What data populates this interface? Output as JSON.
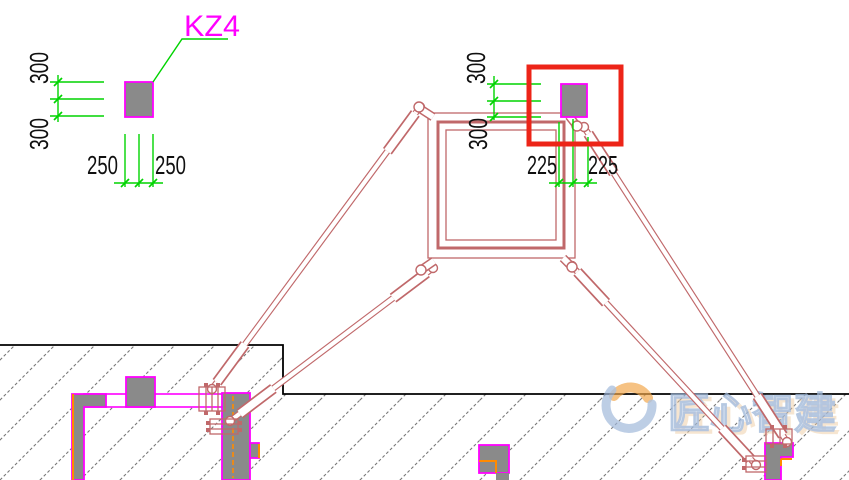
{
  "drawing": {
    "column_tag": {
      "label": "KZ4"
    },
    "left_column": {
      "dim_top": "300",
      "dim_bottom": "300",
      "dim_left": "250",
      "dim_right": "250"
    },
    "right_column": {
      "dim_top": "300",
      "dim_bottom": "300",
      "dim_left": "225",
      "dim_right": "225"
    },
    "watermark": {
      "text": "匠心智建"
    },
    "colors": {
      "green": "#00D400",
      "magenta": "#FF00FF",
      "salmon": "#C0686A",
      "red": "#ED2418",
      "gray": "#8A8A8A",
      "orange": "#FF8A00",
      "hatch": "#787878",
      "wm_blue": "#9FB7D9",
      "wm_tan": "#EBC79B",
      "wm_orange": "#F2A648"
    }
  }
}
